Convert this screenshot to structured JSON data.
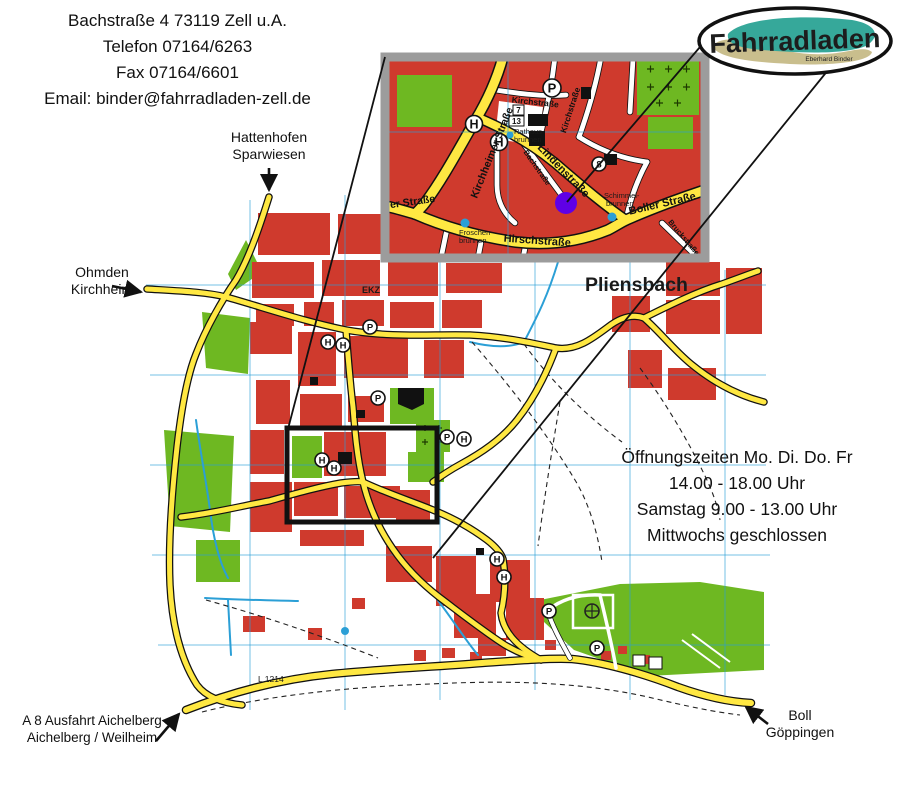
{
  "contact": {
    "line1": "Bachstraße 4 73119 Zell u.A.",
    "line2": "Telefon 07164/6263",
    "line3": "Fax 07164/6601",
    "line4": "Email: binder@fahrradladen-zell.de"
  },
  "logo": {
    "title": "Fahrradladen",
    "subtitle": "Eberhard Binder"
  },
  "hours": {
    "line1": "Öffnungszeiten Mo. Di. Do. Fr",
    "line2": "14.00 - 18.00 Uhr",
    "line3": "Samstag 9.00 - 13.00 Uhr",
    "line4": "Mittwochs geschlossen"
  },
  "directions": {
    "north": {
      "line1": "Hattenhofen",
      "line2": "Sparwiesen"
    },
    "west": {
      "line1": "Ohmden",
      "line2": "Kirchheim"
    },
    "southwest": {
      "line1": "A 8 Ausfahrt Aichelberg",
      "line2": "Aichelberg / Weilheim"
    },
    "southeast": {
      "line1": "Boll",
      "line2": "Göppingen"
    }
  },
  "main_map": {
    "place": "Pliensbach",
    "road_ref": "L 1214",
    "area": "EKZ"
  },
  "icons": {
    "parking": "P",
    "bus": "H",
    "circle8": "8",
    "house7": "7",
    "house13": "13"
  },
  "inset": {
    "streets": {
      "kirchheimer": "Kirchheimer Straße",
      "mer": "er Straße",
      "hirsch": "Hirschstraße",
      "boller": "Boller Straße",
      "linden": "Lindenstraße",
      "kirch_h": "Kirchstraße",
      "kirch_v": "Kirchstraße",
      "bach": "Bachstraße",
      "bruck": "Bruckstraße"
    },
    "fountains": {
      "rathaus1": "Rathaus-",
      "rathaus2": "brunnen",
      "schimmel1": "Schimmel-",
      "schimmel2": "brunnen",
      "froschen1": "Froschen-",
      "froschen2": "brunnen"
    }
  },
  "colors": {
    "building": "#cf3a2d",
    "green": "#6eb822",
    "road": "#ffe842",
    "water": "#2b9fd6",
    "marker": "#5f00e6",
    "inset_border": "#9c9c9c",
    "logo_teal": "#36a89a",
    "logo_tan": "#c9be8d"
  }
}
